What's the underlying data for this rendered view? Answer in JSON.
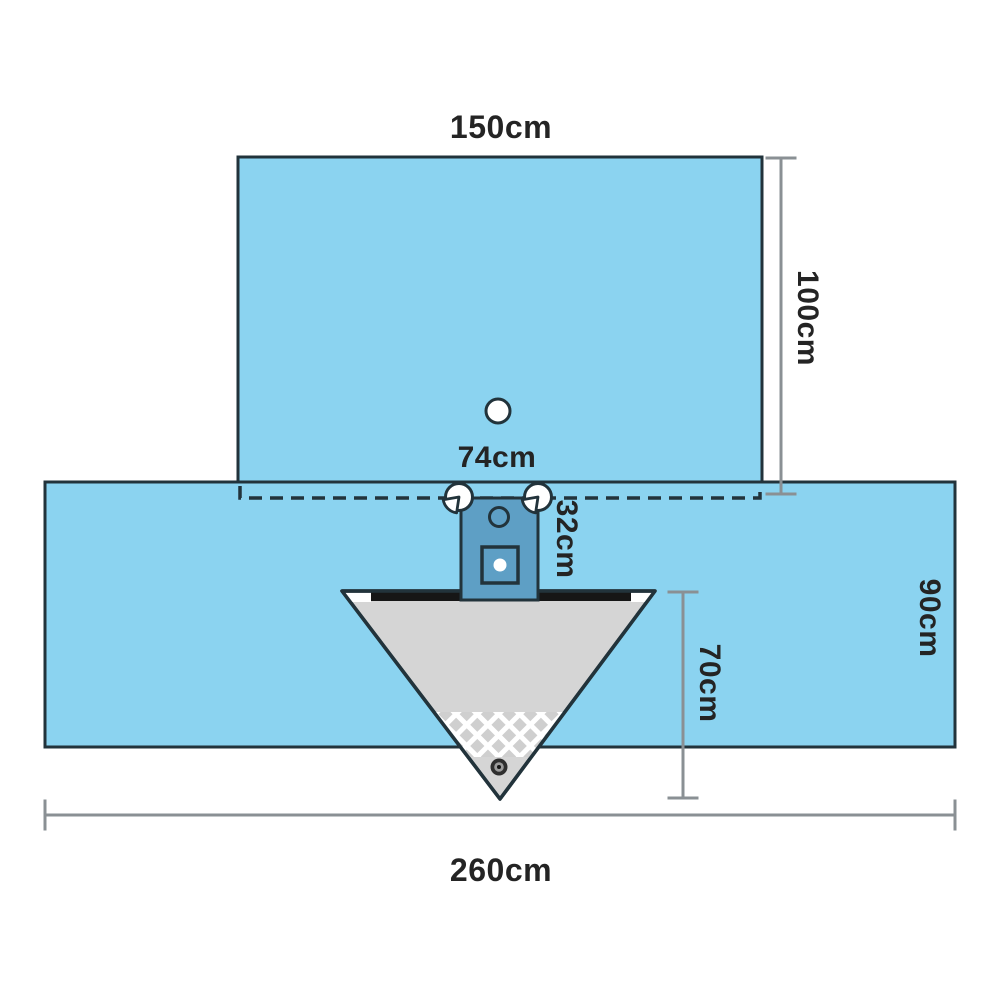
{
  "diagram_title": "surgical-drape-dimension-diagram",
  "labels": {
    "top_width": "150cm",
    "top_height": "100cm",
    "fenestration_width": "74cm",
    "instrument_pouch_height": "32cm",
    "bottom_height": "90cm",
    "collection_pouch_depth": "70cm",
    "bottom_width": "260cm"
  },
  "colors": {
    "drape_blue": "#8bd3f0",
    "pouch_blue": "#5e9fc5",
    "triangle_gray": "#d5d5d5",
    "mesh_cell_gray": "#cfcfcf",
    "mesh_line_white": "#ffffff",
    "bar_black": "#161616",
    "outline_dark": "#22333b",
    "dimension_gray": "#8a9094",
    "text_color": "#242424",
    "background": "#ffffff"
  }
}
